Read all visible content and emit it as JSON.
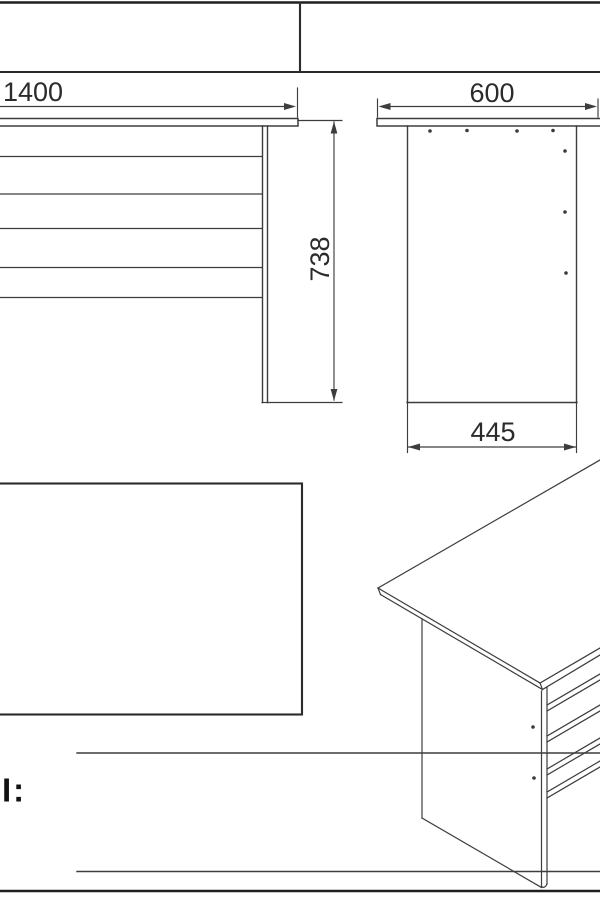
{
  "drawing": {
    "dimensions": {
      "front_width_mm": "1400",
      "front_height_mm": "738",
      "side_depth_mm": "600",
      "side_base_depth_mm": "445"
    },
    "footer_label_fragment": "І:",
    "colors": {
      "background": "#ffffff",
      "drawing_lines": "#3d3d3d",
      "border_lines": "#1f1f1f",
      "dimension_text": "#2b2b2b"
    }
  }
}
